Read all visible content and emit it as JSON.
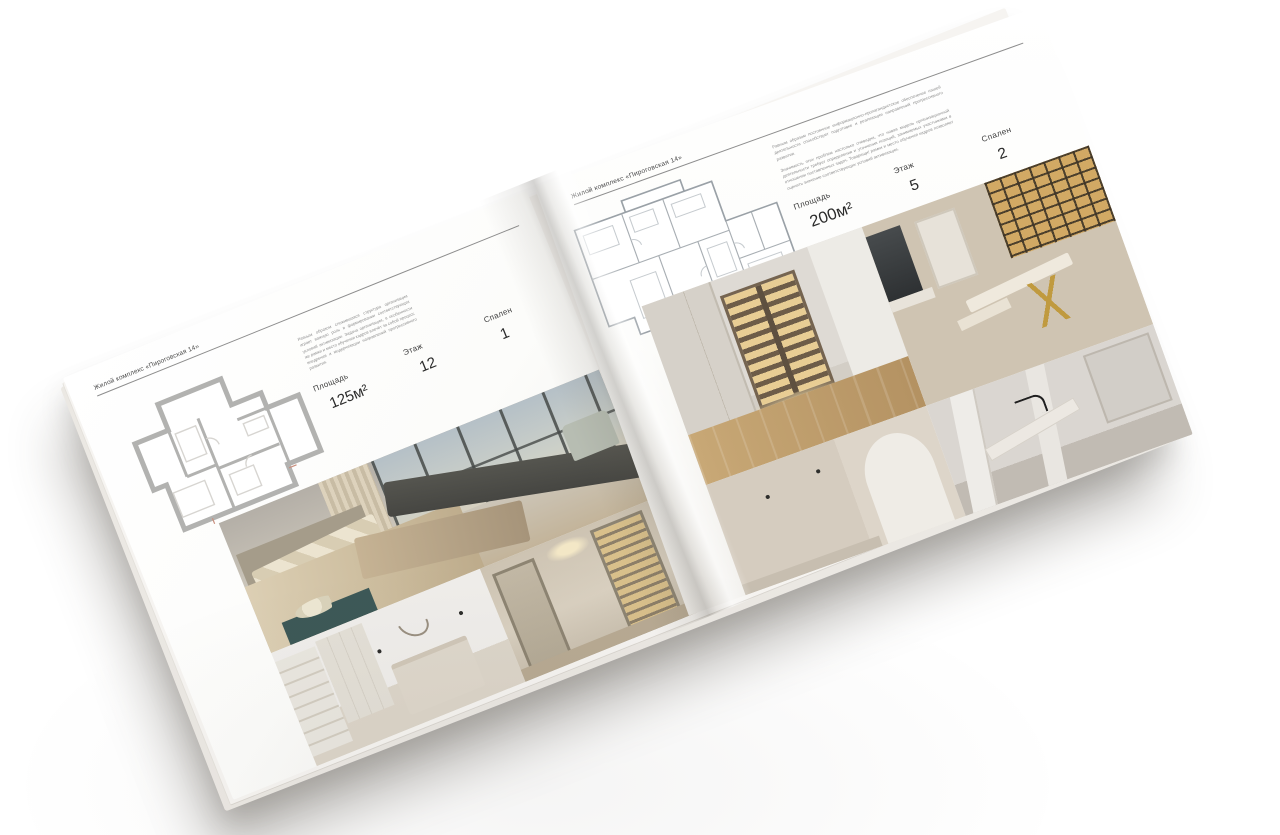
{
  "book": {
    "left_page": {
      "header": "Жилой комплекс «Пироговская 14»",
      "paragraph": "Равным образом сложившаяся структура организации играет важную роль в формировании соответствующих условий активизации. Задача организации, в особенности же рамки и место обучения кадров влечёт за собой процесс внедрения и модернизации направлений прогрессивного развития.",
      "specs": [
        {
          "label": "Площадь",
          "value": "125м²"
        },
        {
          "label": "Этаж",
          "value": "12"
        },
        {
          "label": "Спален",
          "value": "1"
        }
      ]
    },
    "right_page": {
      "header": "Жилой комплекс «Пироговская 14»",
      "paragraphs": [
        "Равным образом постоянное информационно-пропагандистское обеспечение нашей деятельности способствует подготовке и реализации направлений прогрессивного развития.",
        "Значимость этих проблем настолько очевидна, что новая модель организационной деятельности требует определения и уточнения позиций, занимаемых участниками в отношении поставленных задач. Товарищи! рамки и место обучения кадров позволяет оценить значение соответствующих условий активизации."
      ],
      "specs": [
        {
          "label": "Площадь",
          "value": "200м²"
        },
        {
          "label": "Этаж",
          "value": "5"
        },
        {
          "label": "Спален",
          "value": "2"
        }
      ]
    },
    "colors": {
      "paper": "#fafaf8",
      "text_dark": "#3e3e3e",
      "text_muted": "#8f8f8f",
      "photo_beige": "#cfc4b2",
      "photo_wood": "#c8a876",
      "cabinet_glow": "#e8cd94"
    }
  }
}
